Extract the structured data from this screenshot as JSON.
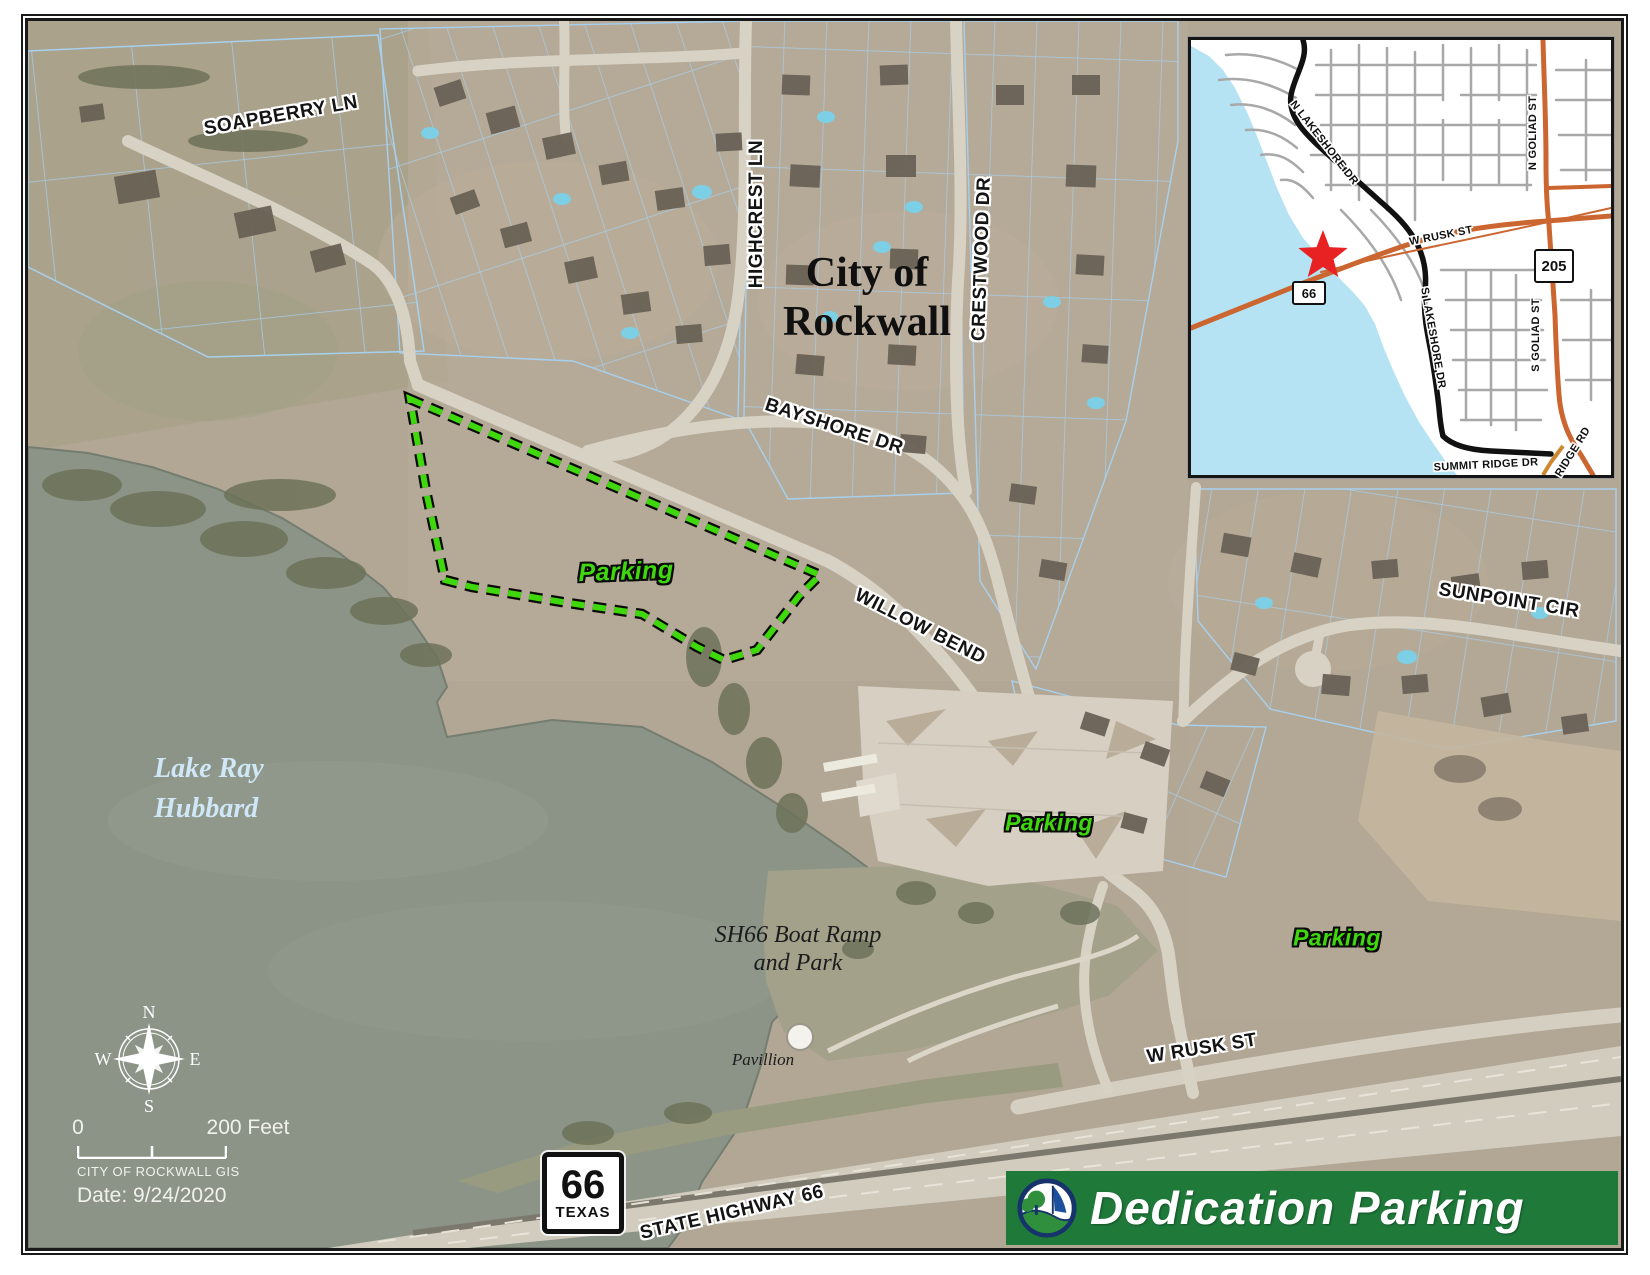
{
  "banner": {
    "title": "Dedication Parking",
    "bg_color": "#1f7a3a"
  },
  "main_map": {
    "city_name_line1": "City of",
    "city_name_line2": "Rockwall",
    "lake_name_line1": "Lake Ray",
    "lake_name_line2": "Hubbard",
    "boat_ramp_line1": "SH66 Boat Ramp",
    "boat_ramp_line2": "and Park",
    "pavilion_label": "Pavillion",
    "streets": {
      "soapberry": "SOAPBERRY LN",
      "highcrest": "HIGHCREST LN",
      "crestwood": "CRESTWOOD DR",
      "bayshore": "BAYSHORE DR",
      "willow_bend": "WILLOW BEND",
      "sunpoint": "SUNPOINT CIR",
      "w_rusk": "W RUSK ST",
      "state_highway": "STATE HIGHWAY 66"
    },
    "parking_labels": [
      "Parking",
      "Parking",
      "Parking"
    ],
    "shield": {
      "number": "66",
      "state": "TEXAS"
    },
    "colors": {
      "dedication_boundary": "#3fd80c",
      "parking_text": "#3fd80c",
      "parcel_lines": "#a7d0ee",
      "water": "#8b9487"
    }
  },
  "inset": {
    "streets": {
      "n_lakeshore": "N LAKESHORE DR",
      "s_lakeshore": "S LAKESHORE DR",
      "w_rusk": "W RUSK ST",
      "summit_ridge": "SUMMIT RIDGE DR",
      "n_goliad": "N GOLIAD ST",
      "s_goliad": "S GOLIAD ST",
      "ridge_rd": "RIDGE RD"
    },
    "shields": {
      "sh66": "66",
      "sh205": "205"
    },
    "marker": "red-star",
    "colors": {
      "water": "#b5e3f4",
      "highway": "#cc6630",
      "major_road": "#111111",
      "street": "#a8a8a8",
      "star": "#e82222"
    }
  },
  "legend": {
    "compass": {
      "n": "N",
      "e": "E",
      "s": "S",
      "w": "W"
    },
    "scale_zero": "0",
    "scale_max": "200 Feet",
    "credit": "CITY OF ROCKWALL GIS",
    "date": "Date: 9/24/2020"
  }
}
